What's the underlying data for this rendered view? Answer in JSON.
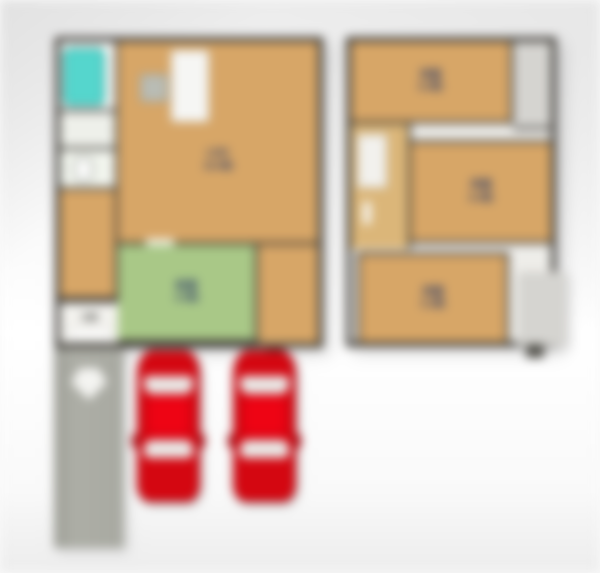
{
  "floor_plan": {
    "rooms": [
      {
        "id": "ldk",
        "name": "LDK",
        "size": "16.0帖",
        "floor_color": "#d7a667"
      },
      {
        "id": "japanese-room",
        "name": "和室",
        "size": "4.5帖",
        "floor_color": "#a9c887"
      },
      {
        "id": "bedroom-top",
        "name": "洋室",
        "size": "6.0帖",
        "floor_color": "#d7a667"
      },
      {
        "id": "bedroom-mid",
        "name": "洋室",
        "size": "6.0帖",
        "floor_color": "#d7a667"
      },
      {
        "id": "bedroom-bottom",
        "name": "洋室",
        "size": "5.2帖",
        "floor_color": "#d7a667"
      },
      {
        "id": "entrance",
        "name": "玄関",
        "size": "",
        "floor_color": "#f3f2ee"
      }
    ],
    "fixtures": [
      {
        "name": "bathtub-icon",
        "color": "#55d6cd"
      },
      {
        "name": "kitchen-counter-icon",
        "color": "#f6f6f4"
      },
      {
        "name": "toilet-icon",
        "color": "#ffffff"
      }
    ],
    "parking": {
      "car_count": 2,
      "car_color": "#d40711"
    },
    "colors": {
      "walls": "#3d3a35",
      "wood_floor": "#d7a667",
      "tatami_floor": "#a9c887",
      "hallway": "#dbb679",
      "closet": "#d5d4d0",
      "approach_path": "#a8a9a1",
      "car_body": "#d40711",
      "car_roof": "#ee0414",
      "car_glass": "#e9e9e7",
      "label_text": "#2e3d68",
      "background": "#f2f2f2"
    }
  }
}
